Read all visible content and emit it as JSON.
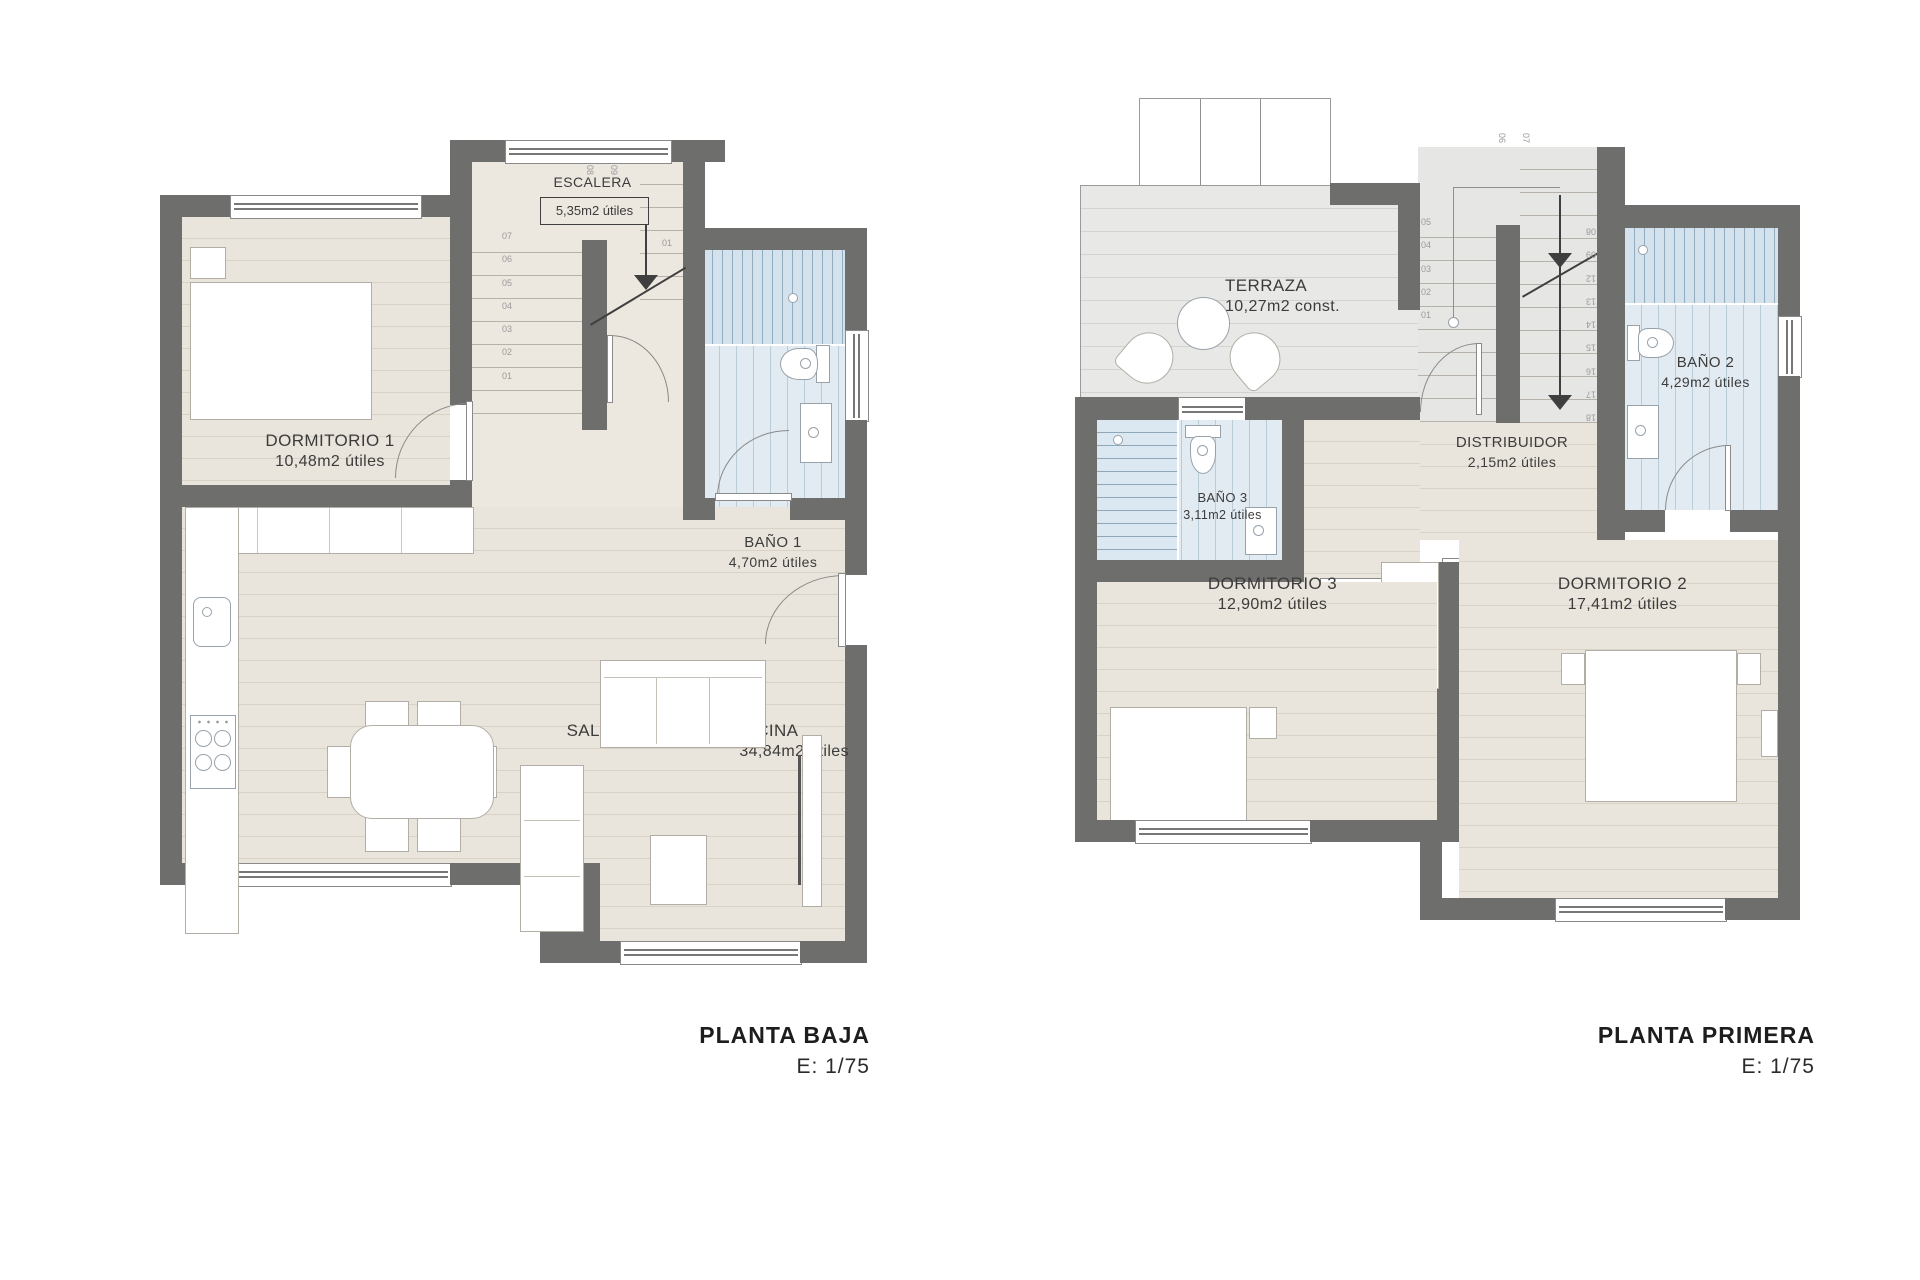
{
  "sheet": {
    "background": "#ffffff"
  },
  "palette": {
    "wall": "#6e6e6c",
    "wood_floor": "#eae5dc",
    "wood_stripe": "#d9d2c6",
    "terrace_floor": "#e8e8e6",
    "tile_floor": "#e2ebf2",
    "tile_stripe": "#b9cdd9",
    "shower_stripe": "#94adbe",
    "line_dark": "#3f3f3f",
    "line_light": "#8f8f8f",
    "text": "#3c3c3c"
  },
  "plans": [
    {
      "id": "planta-baja",
      "title": "PLANTA BAJA",
      "scale": "E: 1/75",
      "rooms": [
        {
          "name": "ESCALERA",
          "area": "5,35m2 útiles"
        },
        {
          "name": "DORMITORIO 1",
          "area": "10,48m2 útiles"
        },
        {
          "name": "BAÑO 1",
          "area": "4,70m2 útiles"
        },
        {
          "name": "SALÓN-COMEDOR-COCINA",
          "area": "34,84m2 útiles"
        }
      ],
      "stair_numbers_left": [
        "07",
        "06",
        "05",
        "04",
        "03",
        "02",
        "01"
      ],
      "stair_numbers_top": [
        "08",
        "09"
      ],
      "stair_number_right": "01"
    },
    {
      "id": "planta-primera",
      "title": "PLANTA PRIMERA",
      "scale": "E: 1/75",
      "rooms": [
        {
          "name": "TERRAZA",
          "area": "10,27m2 const."
        },
        {
          "name": "BAÑO 3",
          "area": "3,11m2 útiles"
        },
        {
          "name": "DISTRIBUIDOR",
          "area": "2,15m2 útiles"
        },
        {
          "name": "BAÑO 2",
          "area": "4,29m2 útiles"
        },
        {
          "name": "DORMITORIO 3",
          "area": "12,90m2 útiles"
        },
        {
          "name": "DORMITORIO 2",
          "area": "17,41m2 útiles"
        }
      ],
      "stair_numbers_left": [
        "05",
        "04",
        "03",
        "02",
        "01"
      ],
      "stair_numbers_top": [
        "06",
        "07"
      ],
      "stair_numbers_right": [
        "08",
        "09",
        "12",
        "13",
        "14",
        "15",
        "16",
        "17",
        "18"
      ]
    }
  ]
}
